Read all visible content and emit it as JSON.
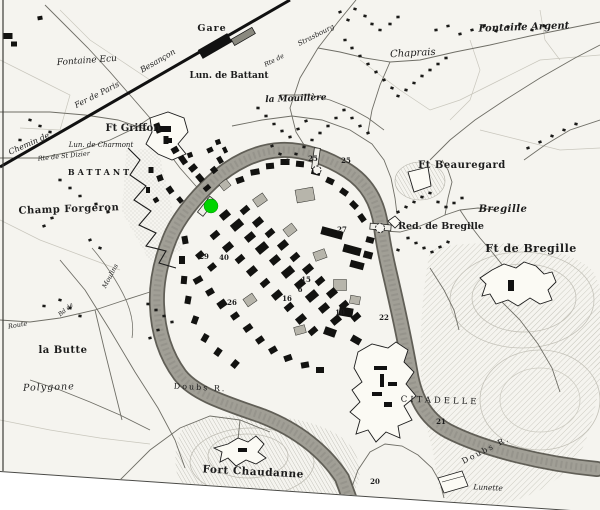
{
  "map": {
    "kind": "engraved-city-map",
    "city_features_note": "historic engraved plan with river loop, forts and railway",
    "marker": {
      "x": 211,
      "y": 206,
      "radius": 7,
      "color": "#00d400",
      "name": "selected-location"
    },
    "colors": {
      "paper": "#f5f4ef",
      "ink": "#1c1c1c",
      "river_bank": "#615f57",
      "river_water": "#a19f96",
      "hill_hatch": "#b3b1a6",
      "road": "#6f6e66"
    },
    "labels": [
      {
        "id": "gare",
        "text": "Gare",
        "x": 212,
        "y": 31,
        "rot": 0,
        "fs": 9.5,
        "it": false,
        "b": true,
        "sp": 1
      },
      {
        "id": "besancon",
        "text": "Besançon",
        "x": 159,
        "y": 63,
        "rot": -30,
        "fs": 8,
        "it": true,
        "b": false,
        "sp": 0
      },
      {
        "id": "fer-de-paris",
        "text": "Fer de Paris",
        "x": 98,
        "y": 97,
        "rot": -27,
        "fs": 8,
        "it": true,
        "b": false,
        "sp": 0
      },
      {
        "id": "chemin-de",
        "text": "Chemin de",
        "x": 30,
        "y": 146,
        "rot": -24,
        "fs": 8,
        "it": true,
        "b": false,
        "sp": 0
      },
      {
        "id": "rte-st-dizier",
        "text": "Rte de St Dizier",
        "x": 64,
        "y": 158,
        "rot": -6,
        "fs": 6.5,
        "it": true,
        "b": false,
        "sp": 0
      },
      {
        "id": "fontaine-ecu",
        "text": "Fontaine Ecu",
        "x": 87,
        "y": 63,
        "rot": -4,
        "fs": 9,
        "it": true,
        "b": false,
        "sp": 0
      },
      {
        "id": "lun-de-battant",
        "text": "Lun. de Battant",
        "x": 229,
        "y": 78,
        "rot": 0,
        "fs": 9,
        "it": false,
        "b": true,
        "sp": 0
      },
      {
        "id": "la-mouillere",
        "text": "la Mouillère",
        "x": 296,
        "y": 101,
        "rot": -2,
        "fs": 9,
        "it": true,
        "b": true,
        "sp": 0
      },
      {
        "id": "chaprais",
        "text": "Chaprais",
        "x": 413,
        "y": 56,
        "rot": -3,
        "fs": 10,
        "it": true,
        "b": false,
        "sp": 0
      },
      {
        "id": "fontaine-argent",
        "text": "Fontaine Argent",
        "x": 524,
        "y": 30,
        "rot": -2,
        "fs": 10,
        "it": true,
        "b": true,
        "sp": 0
      },
      {
        "id": "ft-griffon",
        "text": "Ft Griffon",
        "x": 133,
        "y": 131,
        "rot": 0,
        "fs": 10,
        "it": false,
        "b": true,
        "sp": 0
      },
      {
        "id": "lun-de-charmont",
        "text": "Lun. de Charmont",
        "x": 101,
        "y": 147,
        "rot": 0,
        "fs": 7,
        "it": true,
        "b": false,
        "sp": 0
      },
      {
        "id": "battant",
        "text": "BATTANT",
        "x": 100,
        "y": 175,
        "rot": 0,
        "fs": 8,
        "it": false,
        "b": true,
        "sp": 3
      },
      {
        "id": "champ-forgeron",
        "text": "Champ Forgeron",
        "x": 69,
        "y": 212,
        "rot": -2,
        "fs": 10,
        "it": false,
        "b": true,
        "sp": 0.5
      },
      {
        "id": "strasbourg",
        "text": "Strasbourg",
        "x": 317,
        "y": 37,
        "rot": -27,
        "fs": 7,
        "it": true,
        "b": false,
        "sp": 0
      },
      {
        "id": "rte-de",
        "text": "Rte de",
        "x": 275,
        "y": 62,
        "rot": -27,
        "fs": 6.5,
        "it": true,
        "b": false,
        "sp": 0
      },
      {
        "id": "ft-beauregard",
        "text": "Ft Beauregard",
        "x": 462,
        "y": 168,
        "rot": 0,
        "fs": 10,
        "it": false,
        "b": true,
        "sp": 0.5
      },
      {
        "id": "bregille",
        "text": "Bregille",
        "x": 503,
        "y": 212,
        "rot": 0,
        "fs": 10,
        "it": true,
        "b": true,
        "sp": 0.5
      },
      {
        "id": "red-de-bregille",
        "text": "Red. de Bregille",
        "x": 441,
        "y": 229,
        "rot": 0,
        "fs": 9.5,
        "it": false,
        "b": true,
        "sp": 0
      },
      {
        "id": "ft-de-bregille",
        "text": "Ft de Bregille",
        "x": 531,
        "y": 252,
        "rot": 0,
        "fs": 11,
        "it": false,
        "b": true,
        "sp": 0.5
      },
      {
        "id": "la-butte",
        "text": "la Butte",
        "x": 63,
        "y": 353,
        "rot": 0,
        "fs": 10,
        "it": false,
        "b": true,
        "sp": 0.5
      },
      {
        "id": "polygone",
        "text": "Polygone",
        "x": 49,
        "y": 390,
        "rot": -2,
        "fs": 9.5,
        "it": true,
        "b": false,
        "sp": 1
      },
      {
        "id": "route",
        "text": "Route",
        "x": 18,
        "y": 327,
        "rot": -10,
        "fs": 6.5,
        "it": true,
        "b": false,
        "sp": 0
      },
      {
        "id": "moulins",
        "text": "Moulins",
        "x": 112,
        "y": 277,
        "rot": -62,
        "fs": 6.5,
        "it": true,
        "b": false,
        "sp": 0
      },
      {
        "id": "bd-de",
        "text": "Bd de",
        "x": 67,
        "y": 311,
        "rot": -40,
        "fs": 6,
        "it": true,
        "b": false,
        "sp": 0
      },
      {
        "id": "doubs-r-west",
        "text": "Doubs  R.",
        "x": 200,
        "y": 390,
        "rot": 3,
        "fs": 8,
        "it": false,
        "b": false,
        "sp": 2
      },
      {
        "id": "fort-chaudanne",
        "text": "Fort Chaudanne",
        "x": 253,
        "y": 475,
        "rot": 3,
        "fs": 10.5,
        "it": false,
        "b": true,
        "sp": 0.5
      },
      {
        "id": "citadelle",
        "text": "CITADELLE",
        "x": 440,
        "y": 403,
        "rot": 2,
        "fs": 8.5,
        "it": false,
        "b": false,
        "sp": 3
      },
      {
        "id": "doubs-r-east",
        "text": "Doubs  R.",
        "x": 487,
        "y": 452,
        "rot": -27,
        "fs": 8,
        "it": false,
        "b": false,
        "sp": 2
      },
      {
        "id": "lunette",
        "text": "Lunette",
        "x": 488,
        "y": 490,
        "rot": 3,
        "fs": 7.5,
        "it": true,
        "b": false,
        "sp": 0
      }
    ],
    "numbers": [
      {
        "text": "25",
        "x": 313,
        "y": 161
      },
      {
        "text": "25",
        "x": 346,
        "y": 163
      },
      {
        "text": "27",
        "x": 342,
        "y": 232
      },
      {
        "text": "29",
        "x": 204,
        "y": 259
      },
      {
        "text": "40",
        "x": 224,
        "y": 260
      },
      {
        "text": "26",
        "x": 232,
        "y": 305
      },
      {
        "text": "15",
        "x": 306,
        "y": 282
      },
      {
        "text": "6",
        "x": 300,
        "y": 292
      },
      {
        "text": "16",
        "x": 287,
        "y": 301
      },
      {
        "text": "10",
        "x": 340,
        "y": 315
      },
      {
        "text": "22",
        "x": 384,
        "y": 320
      },
      {
        "text": "21",
        "x": 441,
        "y": 424
      },
      {
        "text": "20",
        "x": 375,
        "y": 484
      }
    ],
    "gate_symbols": [
      {
        "x": 317,
        "y": 170,
        "r": 4
      },
      {
        "x": 380,
        "y": 228,
        "r": 4.5
      }
    ]
  }
}
